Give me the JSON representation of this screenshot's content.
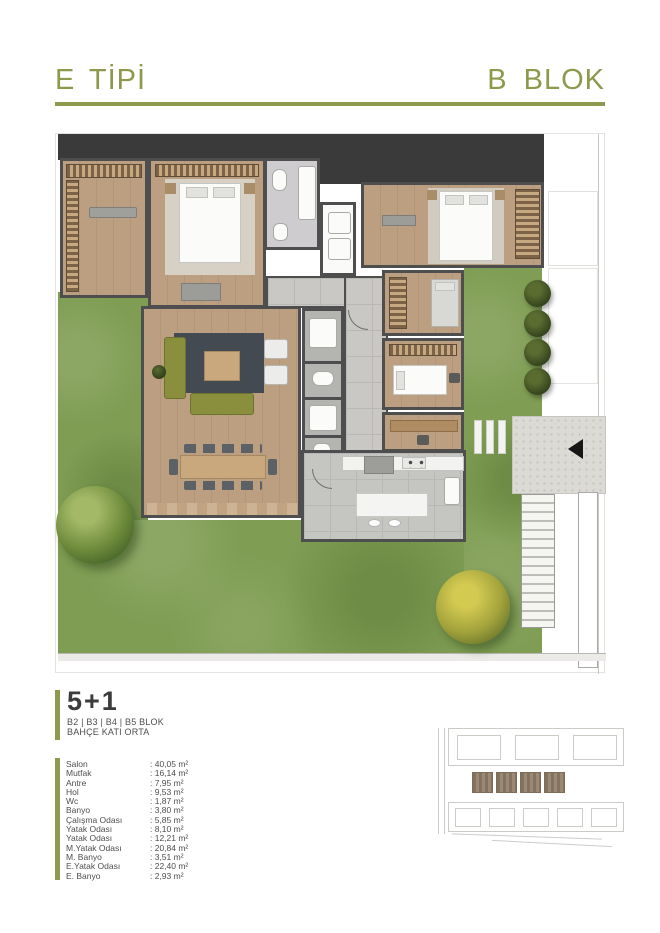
{
  "header": {
    "left_title": "E TİPİ",
    "right_title": "B BLOK"
  },
  "unit": {
    "type_label": "5+1",
    "blocks_label": "B2 | B3 | B4 | B5 BLOK",
    "floor_label": "BAHÇE KATI ORTA"
  },
  "room_list": [
    {
      "name": "Salon",
      "area": ": 40,05 m²"
    },
    {
      "name": "Mutfak",
      "area": ": 16,14 m²"
    },
    {
      "name": "Antre",
      "area": ": 7,95 m²"
    },
    {
      "name": "Hol",
      "area": ": 9,53 m²"
    },
    {
      "name": "Wc",
      "area": ": 1,87 m²"
    },
    {
      "name": "Banyo",
      "area": ": 3,80 m²"
    },
    {
      "name": "Çalışma Odası",
      "area": ": 5,85 m²"
    },
    {
      "name": "Yatak Odası",
      "area": ": 8,10 m²"
    },
    {
      "name": "Yatak Odası",
      "area": ": 12,21 m²"
    },
    {
      "name": "M.Yatak Odası",
      "area": ": 20,84 m²"
    },
    {
      "name": "M. Banyo",
      "area": ": 3,51 m²"
    },
    {
      "name": "E.Yatak Odası",
      "area": ": 22,40 m²"
    },
    {
      "name": "E. Banyo",
      "area": ": 2,93 m²"
    }
  ],
  "colors": {
    "accent": "#8c9a4e",
    "text": "#4e4e4e",
    "wall": "#4e4e4e",
    "dark_roof": "#3a3a3a",
    "grass": "#7f9d53",
    "wood_floor": "#b79b7c",
    "tile_floor": "#cac8c4",
    "sofa": "#8a8f3e",
    "rug": "#434a52",
    "concrete": "#dcdad4",
    "site_highlight": "#9b8974"
  },
  "siteplan": {
    "top_row_count": 3,
    "highlighted_count": 4,
    "bottom_row_count": 5
  }
}
